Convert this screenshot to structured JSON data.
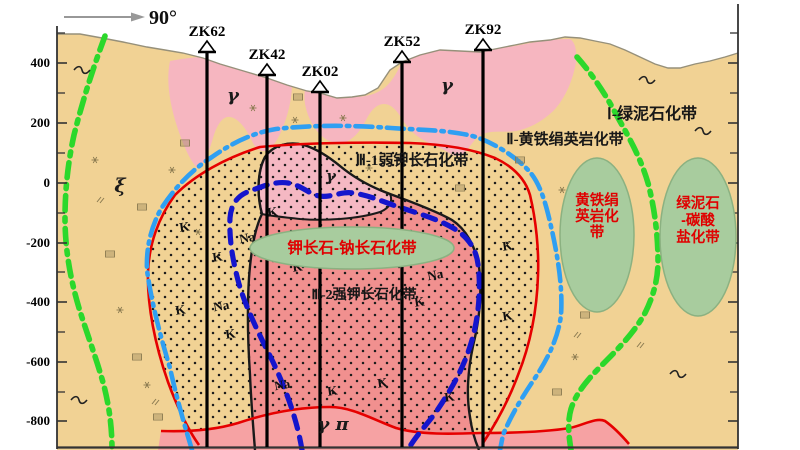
{
  "compass": {
    "label": "90°"
  },
  "axis": {
    "labels": [
      {
        "text": "400",
        "y": 63
      },
      {
        "text": "200",
        "y": 123
      },
      {
        "text": "0",
        "y": 183
      },
      {
        "text": "-200",
        "y": 243
      },
      {
        "text": "-400",
        "y": 302
      },
      {
        "text": "-600",
        "y": 362
      },
      {
        "text": "-800",
        "y": 421
      }
    ],
    "minor_ticks": [
      33,
      93,
      153,
      213,
      272,
      332,
      392
    ]
  },
  "boreholes": [
    {
      "label": "ZK62",
      "x": 207,
      "collar_y": 52
    },
    {
      "label": "ZK42",
      "x": 267,
      "collar_y": 75
    },
    {
      "label": "ZK02",
      "x": 320,
      "collar_y": 92
    },
    {
      "label": "ZK52",
      "x": 402,
      "collar_y": 62
    },
    {
      "label": "ZK92",
      "x": 483,
      "collar_y": 50
    }
  ],
  "zone_labels": [
    {
      "text": "Ⅰ-绿泥石化带",
      "x": 652,
      "y": 119,
      "size": 16
    },
    {
      "text": "Ⅱ-黄铁绢英岩化带",
      "x": 565,
      "y": 144,
      "size": 15
    },
    {
      "text": "Ⅲ-1弱钾长石化带",
      "x": 412,
      "y": 165,
      "size": 15
    },
    {
      "text": "Ⅲ-2强钾长石化带",
      "x": 364,
      "y": 299,
      "size": 14
    }
  ],
  "rock_labels": [
    {
      "text": "γ",
      "x": 233,
      "y": 101,
      "size": 18
    },
    {
      "text": "γ",
      "x": 447,
      "y": 91,
      "size": 18
    },
    {
      "text": "γ",
      "x": 331,
      "y": 181,
      "size": 15
    },
    {
      "text": "γ π",
      "x": 333,
      "y": 430,
      "size": 18
    },
    {
      "text": "ξ",
      "x": 120,
      "y": 192,
      "size": 19
    }
  ],
  "minerals": {
    "k_text": "K",
    "na_text": "Na",
    "k_positions": [
      [
        185,
        231
      ],
      [
        218,
        261
      ],
      [
        273,
        216
      ],
      [
        298,
        271
      ],
      [
        181,
        314
      ],
      [
        231,
        338
      ],
      [
        333,
        395
      ],
      [
        383,
        387
      ],
      [
        420,
        306
      ],
      [
        450,
        401
      ],
      [
        508,
        250
      ],
      [
        508,
        320
      ]
    ],
    "na_positions": [
      [
        248,
        242
      ],
      [
        222,
        310
      ],
      [
        283,
        389
      ],
      [
        436,
        279
      ]
    ]
  },
  "ellipses": [
    {
      "cx": 352,
      "cy": 248,
      "rx": 102,
      "ry": 21,
      "font": 15.5,
      "lines": [
        "钾长石-钠长石化带"
      ],
      "line_y": [
        253
      ]
    },
    {
      "cx": 597,
      "cy": 235,
      "rx": 37,
      "ry": 77,
      "font": 14.5,
      "lines": [
        "黄铁绢",
        "英岩化",
        "带"
      ],
      "line_y": [
        205,
        221,
        237
      ]
    },
    {
      "cx": 698,
      "cy": 237,
      "rx": 38,
      "ry": 79,
      "font": 14.5,
      "lines": [
        "绿泥石",
        "-碳酸",
        "盐化带"
      ],
      "line_y": [
        208,
        225,
        242
      ]
    }
  ],
  "symbols": {
    "rects": [
      [
        142,
        207
      ],
      [
        185,
        143
      ],
      [
        110,
        254
      ],
      [
        137,
        357
      ],
      [
        158,
        417
      ],
      [
        298,
        97
      ],
      [
        460,
        188
      ],
      [
        520,
        160
      ],
      [
        585,
        315
      ],
      [
        557,
        392
      ]
    ],
    "stars": [
      [
        253,
        108
      ],
      [
        295,
        120
      ],
      [
        343,
        118
      ],
      [
        172,
        170
      ],
      [
        95,
        160
      ],
      [
        120,
        310
      ],
      [
        147,
        385
      ],
      [
        562,
        190
      ],
      [
        575,
        357
      ],
      [
        198,
        232
      ],
      [
        369,
        168
      ]
    ],
    "ticks": [
      [
        577,
        335
      ],
      [
        155,
        402
      ],
      [
        100,
        200
      ],
      [
        640,
        345
      ]
    ],
    "tildes": [
      [
        82,
        70
      ],
      [
        647,
        80
      ],
      [
        703,
        131
      ],
      [
        678,
        374
      ],
      [
        79,
        400
      ]
    ]
  },
  "colors": {
    "tan": "#f1d294",
    "pink": "#f6b6c0",
    "head_pink": "#f5b8c3",
    "salmon": "#f1908f",
    "salmon_light": "#f6a2a3",
    "red": "#e60000",
    "cyan_line": "#2f9ff2",
    "blue_line": "#1515cc",
    "green_line": "#2bd82b",
    "ellipse_fill": "#a8cc9e",
    "ellipse_stroke": "#8bb181",
    "ellipse_text": "#e00000",
    "dot": "#1c1c1c",
    "axis": "#333333",
    "surface": "#96907a",
    "symbol": "#8a7a50"
  }
}
